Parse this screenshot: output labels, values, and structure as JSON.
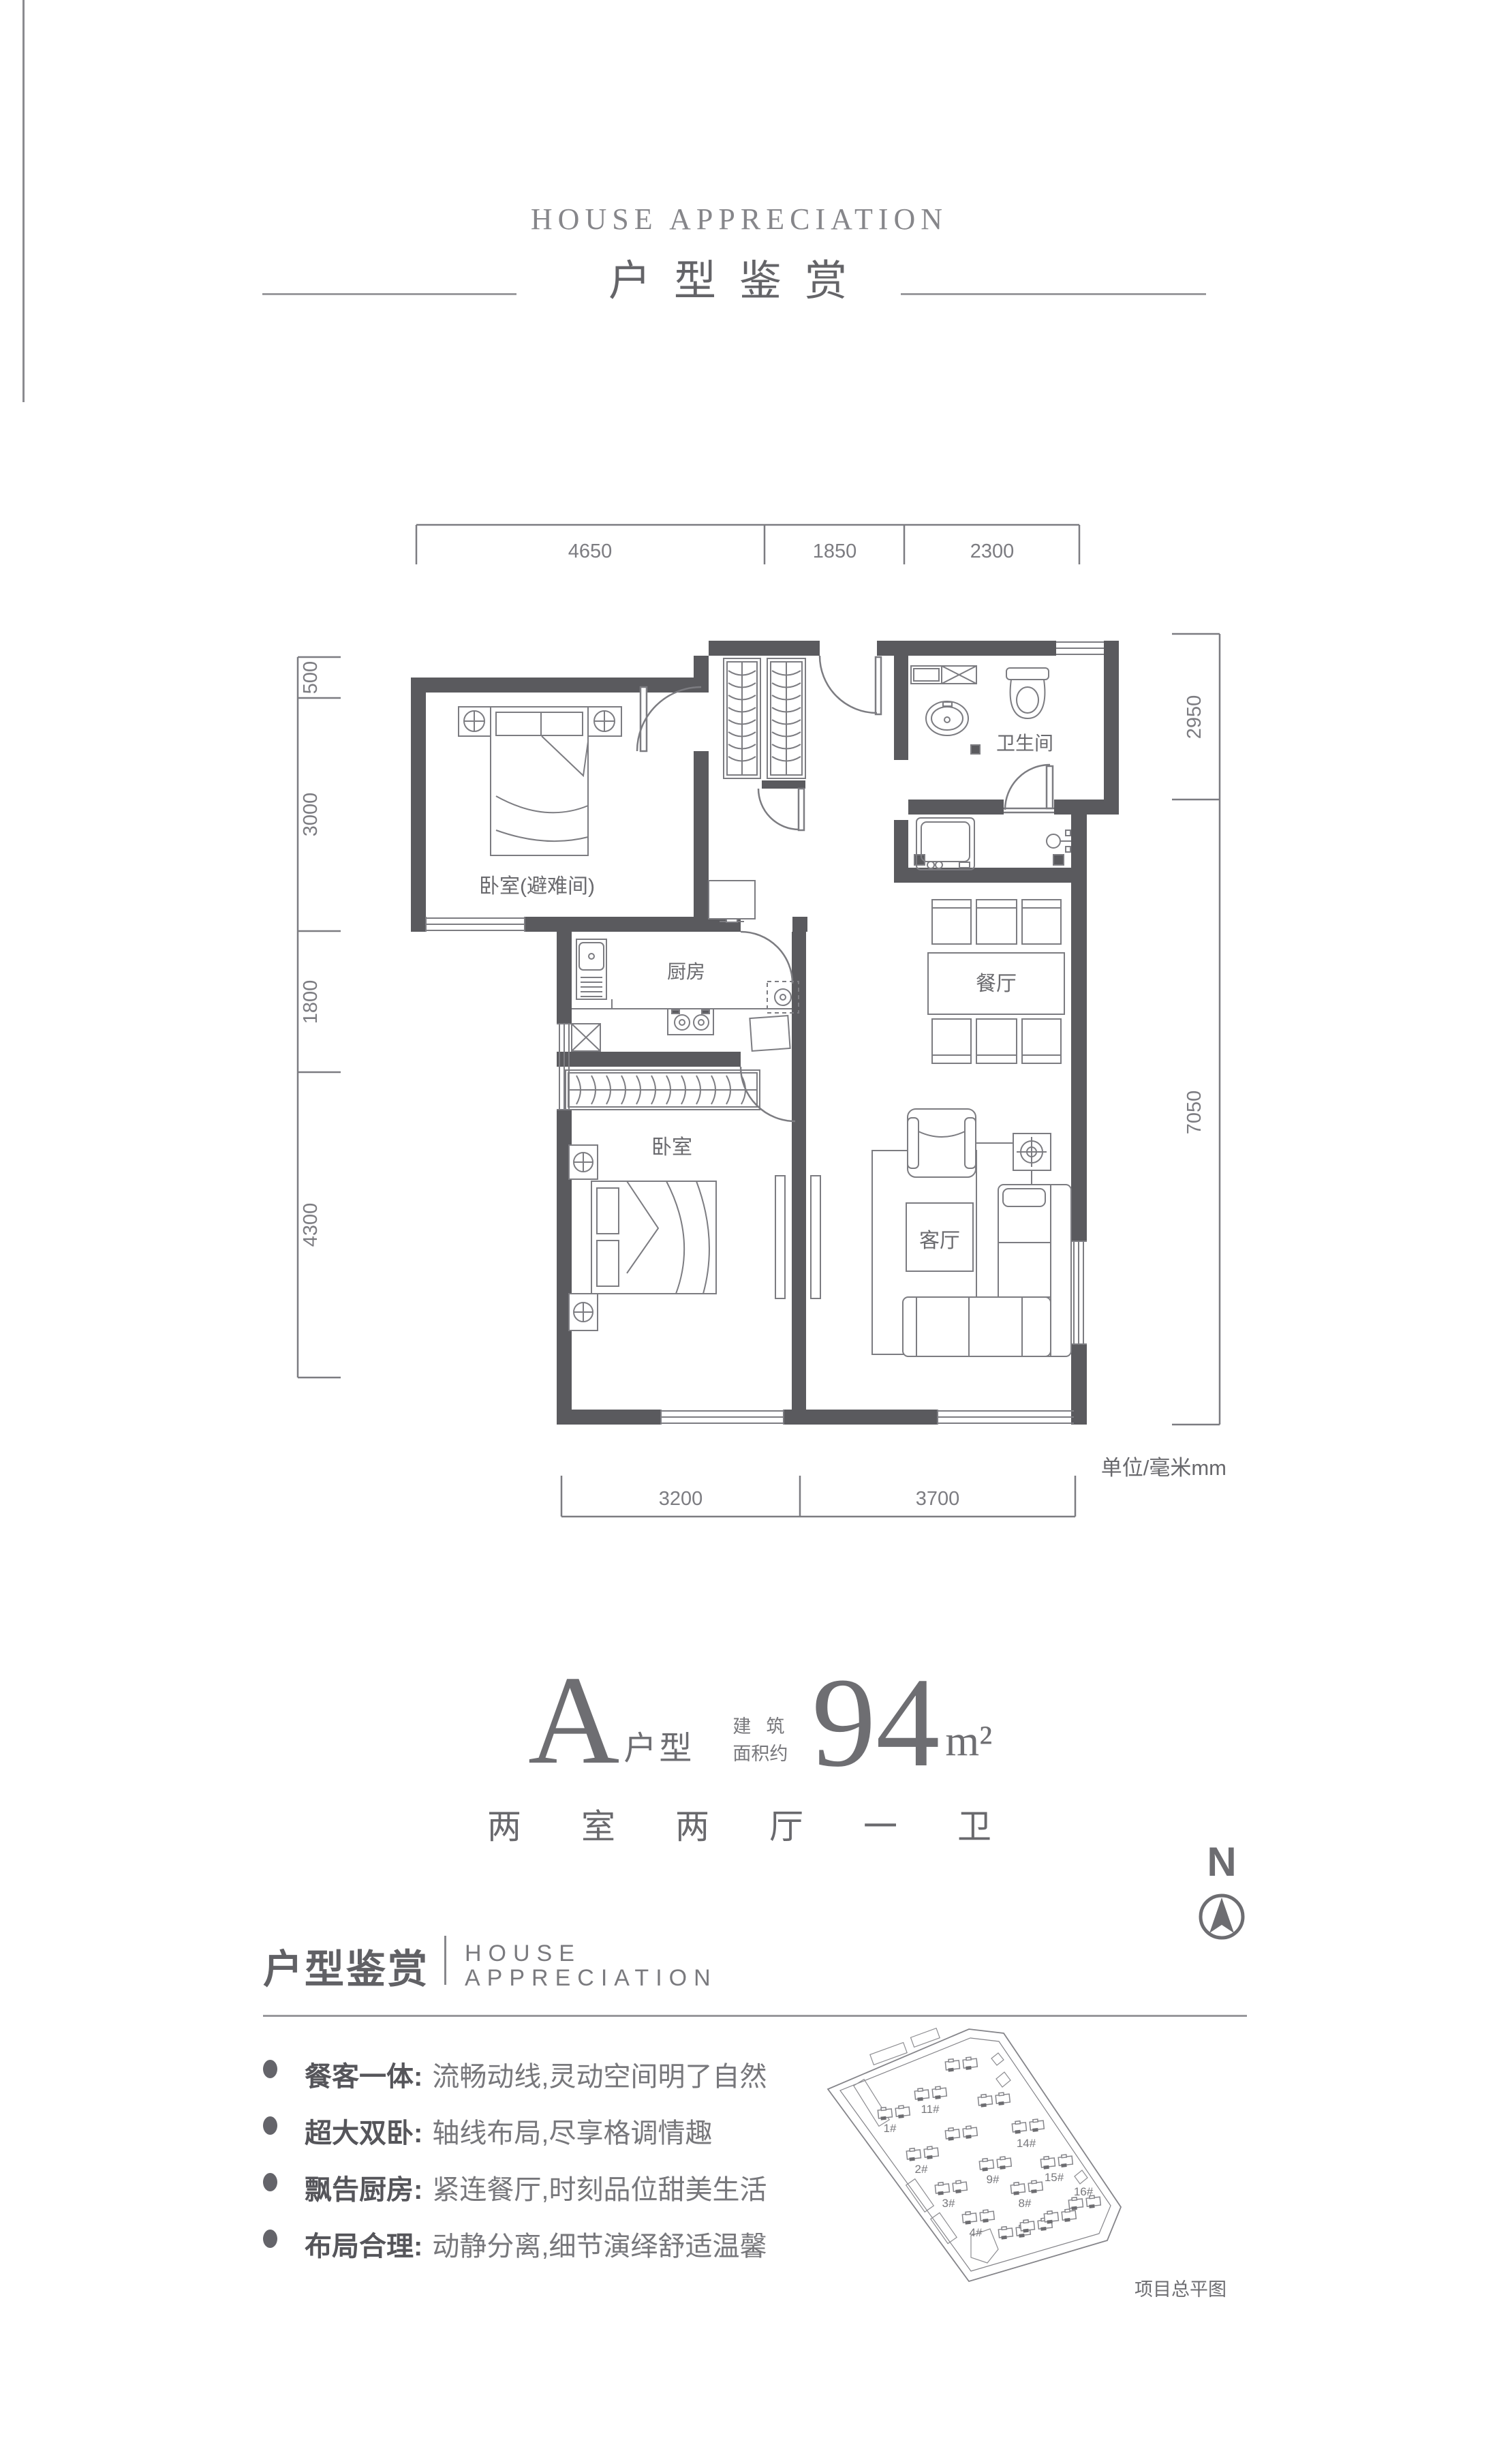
{
  "header": {
    "title_en": "HOUSE APPRECIATION",
    "title_cn": "户型鉴赏"
  },
  "floor_plan": {
    "unit_note": "单位/毫米mm",
    "rooms": {
      "bedroom_refuge": "卧室(避难间)",
      "kitchen": "厨房",
      "bathroom": "卫生间",
      "dining": "餐厅",
      "bedroom": "卧室",
      "living": "客厅"
    },
    "dimensions": {
      "top": [
        "4650",
        "1850",
        "2300"
      ],
      "left": [
        "500",
        "3000",
        "1800",
        "4300"
      ],
      "right": [
        "2950",
        "7050"
      ],
      "bottom": [
        "3200",
        "3700"
      ]
    }
  },
  "unit_info": {
    "type_letter": "A",
    "type_label": "户型",
    "area_prefix_line1": "建筑",
    "area_prefix_line2": "面积约",
    "area_value": "94",
    "area_unit": "m²",
    "layout_text": "两室两厅一卫"
  },
  "compass": {
    "north_label": "N"
  },
  "section": {
    "title_cn": "户型鉴赏",
    "title_en_line1": "HOUSE",
    "title_en_line2": "APPRECIATION",
    "bullets": [
      {
        "label": "餐客一体:",
        "text": "流畅动线,灵动空间明了自然"
      },
      {
        "label": "超大双卧:",
        "text": "轴线布局,尽享格调情趣"
      },
      {
        "label": "飘告厨房:",
        "text": "紧连餐厅,时刻品位甜美生活"
      },
      {
        "label": "布局合理:",
        "text": "动静分离,细节演绎舒适温馨"
      }
    ]
  },
  "site_plan": {
    "caption": "项目总平图",
    "building_labels": [
      "1#",
      "2#",
      "3#",
      "4#",
      "8#",
      "9#",
      "11#",
      "14#",
      "15#",
      "16#"
    ]
  },
  "colors": {
    "wall": "#5a5a5e",
    "line": "#7d7d82",
    "text": "#6b6b6f",
    "light": "#98989c"
  }
}
